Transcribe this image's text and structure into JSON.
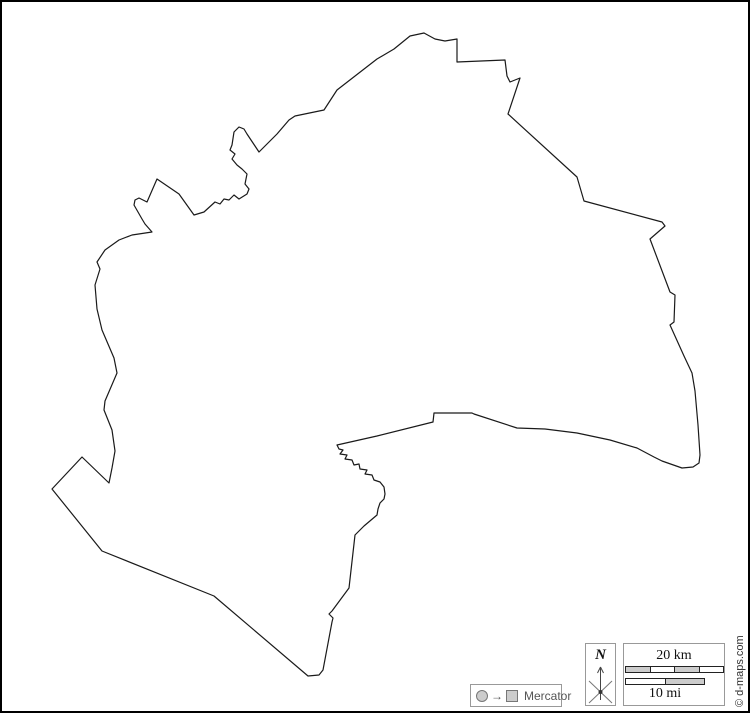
{
  "page": {
    "background": "#ffffff",
    "border_color": "#000000"
  },
  "map": {
    "description": "blank-region-outline",
    "outline_color": "#1a1a1a",
    "outline_fill": "#ffffff",
    "outline_points": [
      [
        422,
        31
      ],
      [
        433,
        37
      ],
      [
        443,
        39
      ],
      [
        455,
        37
      ],
      [
        455,
        60
      ],
      [
        503,
        58
      ],
      [
        505,
        74
      ],
      [
        508,
        80
      ],
      [
        518,
        76
      ],
      [
        506,
        112
      ],
      [
        575,
        175
      ],
      [
        582,
        199
      ],
      [
        660,
        220
      ],
      [
        663,
        224
      ],
      [
        648,
        237
      ],
      [
        668,
        290
      ],
      [
        673,
        293
      ],
      [
        672,
        320
      ],
      [
        668,
        323
      ],
      [
        682,
        354
      ],
      [
        690,
        371
      ],
      [
        693,
        389
      ],
      [
        696,
        423
      ],
      [
        698,
        453
      ],
      [
        697,
        461
      ],
      [
        691,
        465
      ],
      [
        680,
        466
      ],
      [
        660,
        459
      ],
      [
        652,
        455
      ],
      [
        635,
        446
      ],
      [
        608,
        438
      ],
      [
        575,
        431
      ],
      [
        543,
        427
      ],
      [
        515,
        426
      ],
      [
        472,
        412
      ],
      [
        470,
        411
      ],
      [
        432,
        411
      ],
      [
        431,
        420
      ],
      [
        375,
        434
      ],
      [
        335,
        443
      ],
      [
        337,
        447
      ],
      [
        341,
        448
      ],
      [
        338,
        452
      ],
      [
        345,
        453
      ],
      [
        343,
        457
      ],
      [
        350,
        458
      ],
      [
        352,
        463
      ],
      [
        357,
        462
      ],
      [
        358,
        467
      ],
      [
        365,
        468
      ],
      [
        363,
        472
      ],
      [
        370,
        473
      ],
      [
        372,
        478
      ],
      [
        378,
        480
      ],
      [
        382,
        485
      ],
      [
        383,
        492
      ],
      [
        382,
        497
      ],
      [
        378,
        501
      ],
      [
        376,
        507
      ],
      [
        375,
        513
      ],
      [
        362,
        524
      ],
      [
        353,
        533
      ],
      [
        347,
        586
      ],
      [
        330,
        609
      ],
      [
        327,
        612
      ],
      [
        331,
        616
      ],
      [
        330,
        620
      ],
      [
        321,
        668
      ],
      [
        317,
        673
      ],
      [
        306,
        674
      ],
      [
        212,
        594
      ],
      [
        100,
        549
      ],
      [
        50,
        487
      ],
      [
        80,
        455
      ],
      [
        107,
        481
      ],
      [
        110,
        466
      ],
      [
        113,
        449
      ],
      [
        110,
        428
      ],
      [
        102,
        408
      ],
      [
        103,
        399
      ],
      [
        115,
        371
      ],
      [
        112,
        356
      ],
      [
        100,
        328
      ],
      [
        95,
        307
      ],
      [
        93,
        283
      ],
      [
        98,
        267
      ],
      [
        95,
        260
      ],
      [
        103,
        248
      ],
      [
        117,
        238
      ],
      [
        130,
        233
      ],
      [
        150,
        230
      ],
      [
        143,
        222
      ],
      [
        140,
        217
      ],
      [
        132,
        203
      ],
      [
        133,
        198
      ],
      [
        137,
        196
      ],
      [
        145,
        200
      ],
      [
        155,
        177
      ],
      [
        177,
        192
      ],
      [
        192,
        213
      ],
      [
        202,
        210
      ],
      [
        213,
        200
      ],
      [
        218,
        202
      ],
      [
        222,
        197
      ],
      [
        227,
        198
      ],
      [
        232,
        193
      ],
      [
        237,
        197
      ],
      [
        245,
        192
      ],
      [
        247,
        187
      ],
      [
        243,
        182
      ],
      [
        245,
        172
      ],
      [
        240,
        167
      ],
      [
        235,
        163
      ],
      [
        230,
        157
      ],
      [
        233,
        152
      ],
      [
        228,
        148
      ],
      [
        230,
        143
      ],
      [
        232,
        130
      ],
      [
        237,
        125
      ],
      [
        242,
        127
      ],
      [
        245,
        132
      ],
      [
        257,
        150
      ],
      [
        275,
        132
      ],
      [
        287,
        118
      ],
      [
        293,
        114
      ],
      [
        322,
        108
      ],
      [
        335,
        88
      ],
      [
        375,
        57
      ],
      [
        392,
        47
      ],
      [
        408,
        34
      ],
      [
        422,
        31
      ]
    ]
  },
  "legend": {
    "projection": {
      "label": "Mercator",
      "arrow_glyph": "→",
      "icons": [
        "circle-icon",
        "arrow-right-icon",
        "square-icon"
      ]
    },
    "north_indicator": {
      "label": "N",
      "icon": "compass-north-arrow-icon"
    },
    "scale": {
      "km_label": "20 km",
      "mi_label": "10 mi",
      "km_segments": [
        "#cccccc",
        "#ffffff",
        "#cccccc",
        "#ffffff"
      ],
      "mi_segments": [
        "#ffffff",
        "#cccccc"
      ]
    },
    "copyright": "© d-maps.com"
  }
}
